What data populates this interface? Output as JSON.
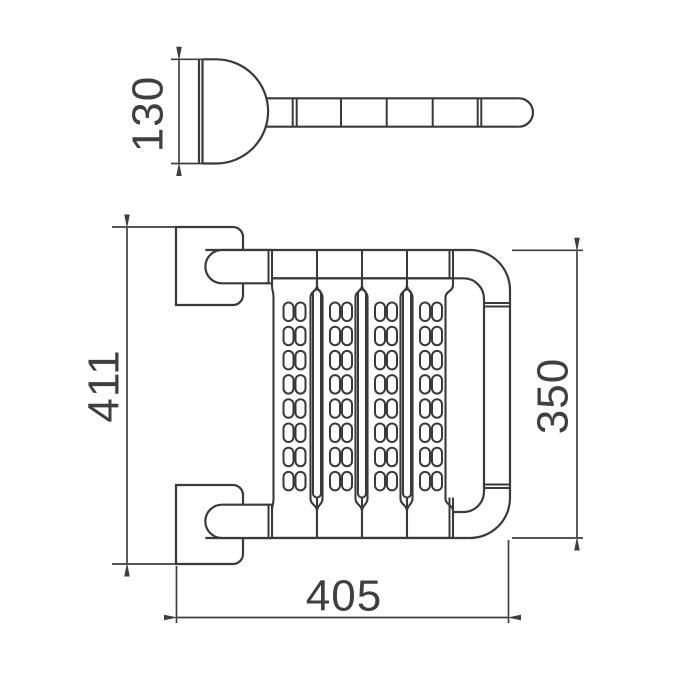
{
  "document": {
    "type": "technical-dimension-drawing",
    "background": "#ffffff"
  },
  "colors": {
    "outline": "#3a3a3a",
    "dimension": "#3f3f3f",
    "text": "#3f3f3f"
  },
  "dimensions": {
    "bracket_depth": {
      "value": "130",
      "view": "side",
      "orientation": "vertical"
    },
    "overall_height": {
      "value": "411",
      "view": "front",
      "orientation": "vertical"
    },
    "rail_frame_height": {
      "value": "350",
      "view": "front",
      "orientation": "vertical"
    },
    "overall_width": {
      "value": "405",
      "view": "front",
      "orientation": "horizontal"
    }
  },
  "structure": {
    "panel_count": 4,
    "slot_rows": 8,
    "slot_columns_per_panel": 2,
    "spacer_bars": 3,
    "side_view_rail_dividers": 5
  }
}
